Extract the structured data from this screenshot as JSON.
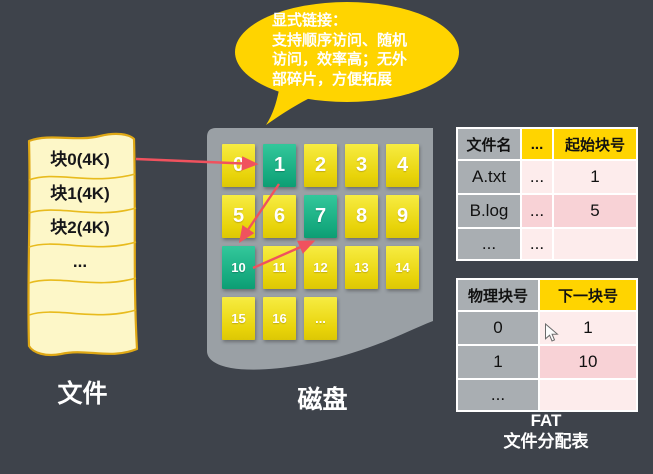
{
  "bubble": {
    "lines": [
      "显式链接：",
      "支持顺序访问、随机",
      "访问，效率高；无外",
      "部碎片，方便拓展"
    ]
  },
  "file": {
    "label": "文件",
    "blocks": [
      "块0(4K)",
      "块1(4K)",
      "块2(4K)",
      "..."
    ]
  },
  "disk": {
    "label": "磁盘",
    "blocks": [
      "0",
      "1",
      "2",
      "3",
      "4",
      "5",
      "6",
      "7",
      "8",
      "9",
      "10",
      "11",
      "12",
      "13",
      "14",
      "15",
      "16",
      "..."
    ],
    "highlighted_blocks": [
      "1",
      "7",
      "10"
    ]
  },
  "directory_table": {
    "headers": [
      "文件名",
      "...",
      "起始块号"
    ],
    "rows": [
      [
        "A.txt",
        "...",
        "1"
      ],
      [
        "B.log",
        "...",
        "5"
      ],
      [
        "...",
        "...",
        ""
      ]
    ]
  },
  "fat_table": {
    "headers": [
      "物理块号",
      "下一块号"
    ],
    "rows": [
      [
        "0",
        "1"
      ],
      [
        "1",
        "10"
      ],
      [
        "...",
        ""
      ]
    ]
  },
  "fat_caption": {
    "line1": "FAT",
    "line2": "文件分配表"
  },
  "links": [
    {
      "from": "file 块0",
      "to": "disk block 1"
    },
    {
      "from": "disk block 1",
      "to": "disk block 10"
    },
    {
      "from": "disk block 10",
      "to": "disk block 7"
    }
  ],
  "colors": {
    "background": "#3e434b",
    "disk_gray": "#9aa0a5",
    "block_yellow": "#e8d309",
    "block_green": "#1cb588",
    "file_paper": "#fdf7c8",
    "table_header_yellow": "#ffd400",
    "table_gray": "#a9aeb2",
    "row_pink_light": "#fdecec",
    "row_pink_dark": "#f8d2d6",
    "arrow_red": "#f0525e",
    "bubble_gold": "#ffd400"
  }
}
